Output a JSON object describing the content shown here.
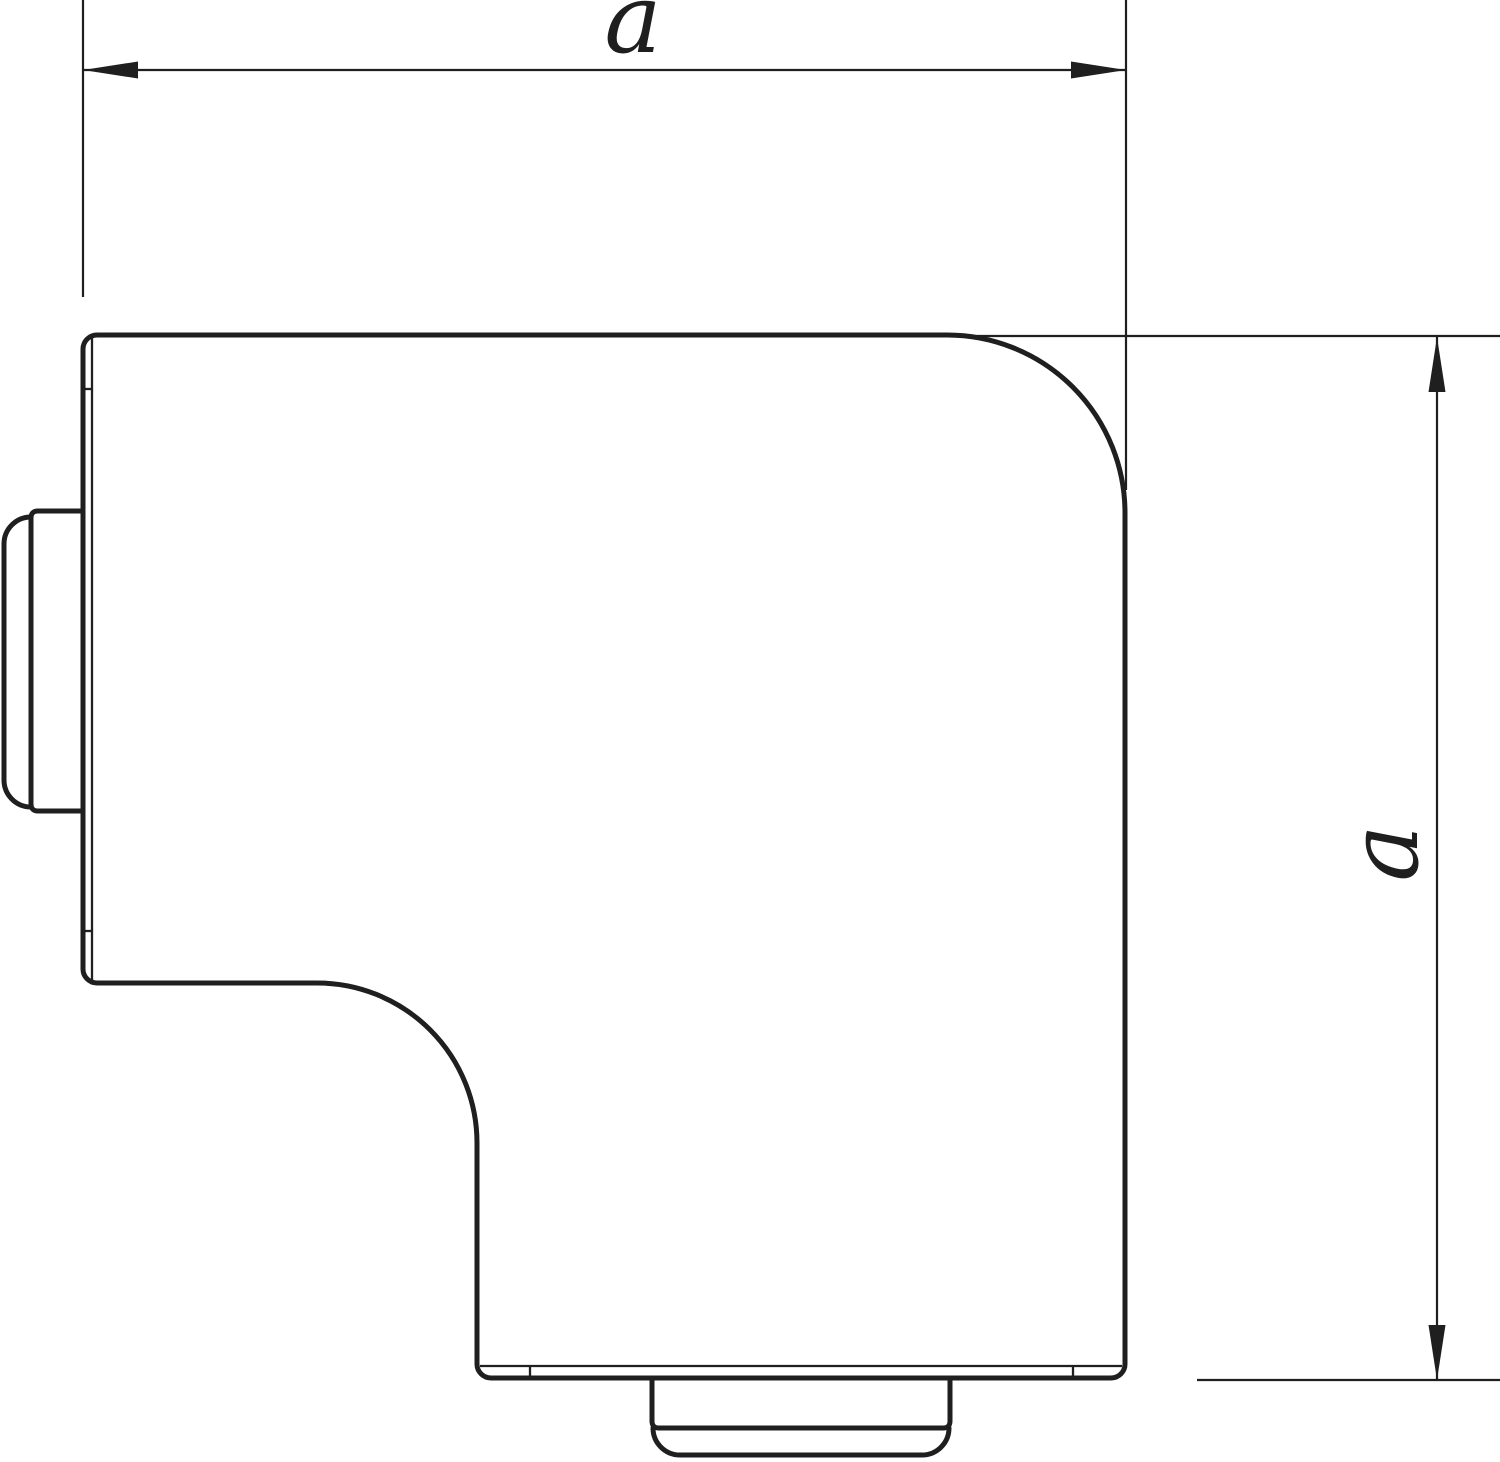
{
  "drawing": {
    "background_color": "#ffffff",
    "line_color": "#1f1f1f",
    "horizontal_dimension": {
      "label": "a"
    },
    "vertical_dimension": {
      "label": "a"
    }
  }
}
